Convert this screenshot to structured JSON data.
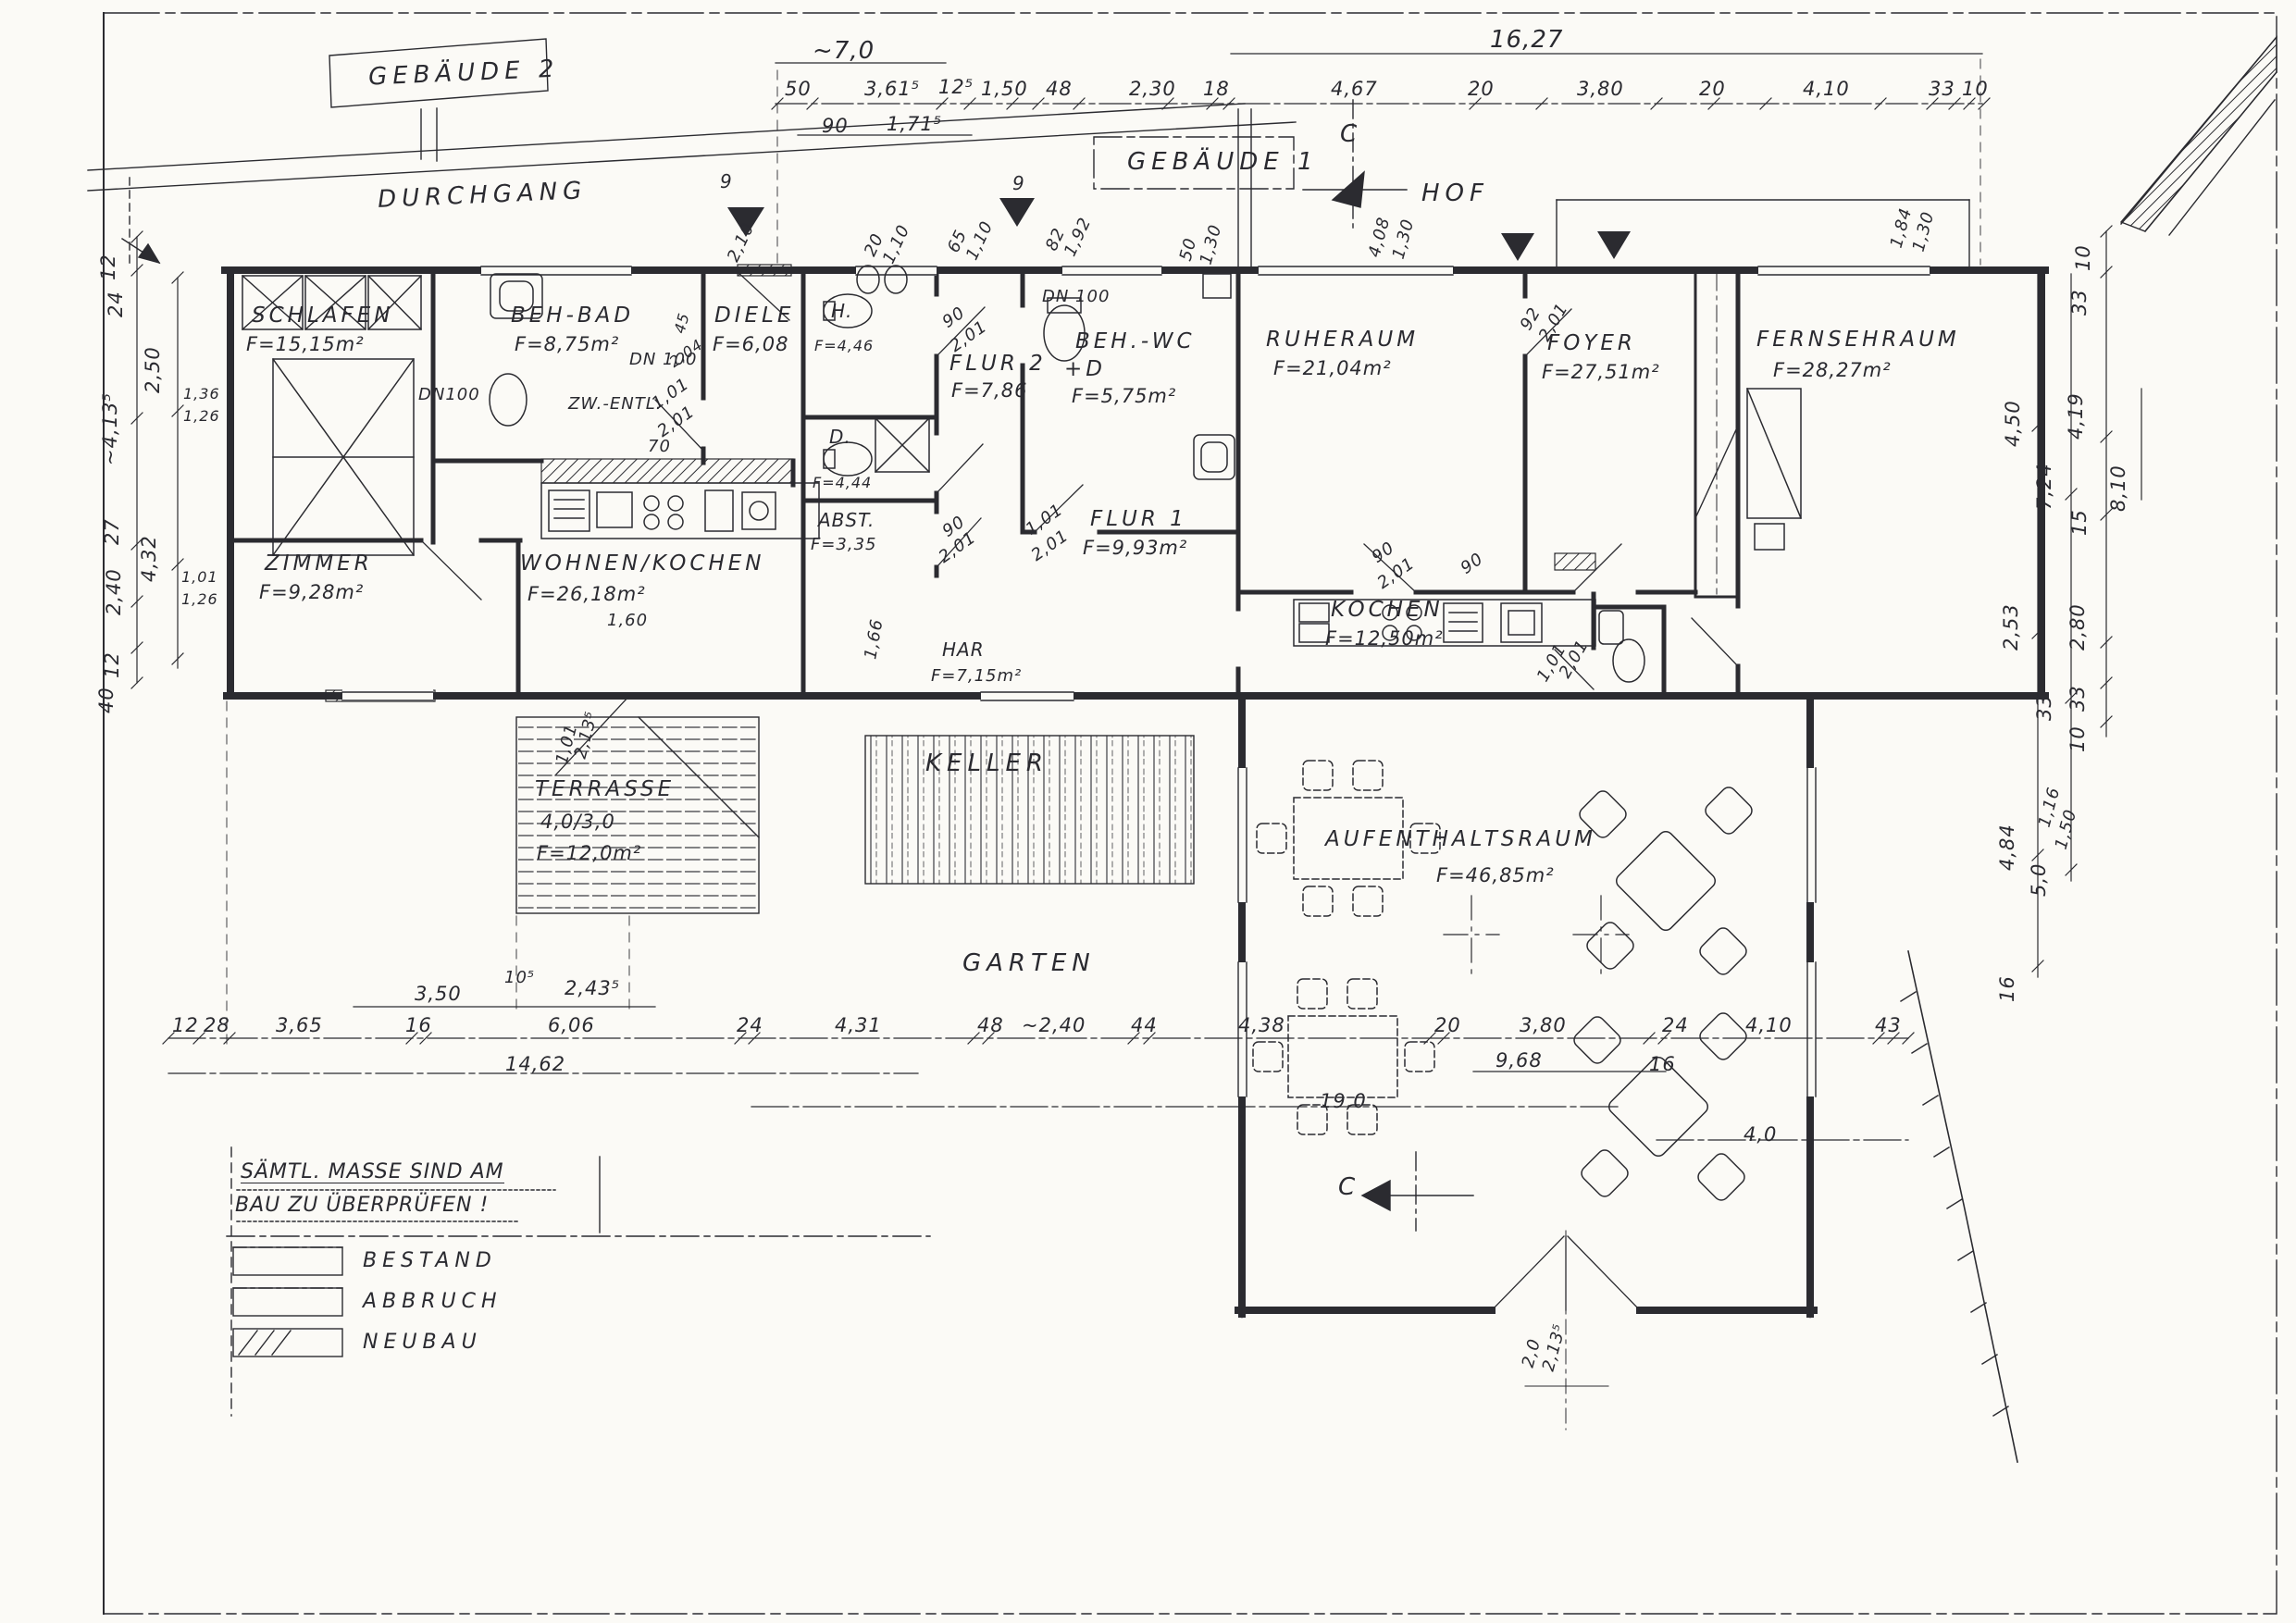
{
  "sheet": {
    "paper_color": "#fbfaf6",
    "ink_color": "#2b2b30"
  },
  "buildings": {
    "b2": "GEBÄUDE 2",
    "b1": "GEBÄUDE 1"
  },
  "zones": {
    "durchgang": "DURCHGANG",
    "hof": "HOF",
    "garten": "GARTEN",
    "keller": "KELLER",
    "terrasse": {
      "name": "TERRASSE",
      "dims": "4,0/3,0",
      "area": "F=12,0m²"
    }
  },
  "rooms": {
    "schlafen": {
      "name": "SCHLAFEN",
      "area": "F=15,15m²"
    },
    "behbad": {
      "name": "BEH-BAD",
      "area": "F=8,75m²"
    },
    "diele": {
      "name": "DIELE",
      "area": "F=6,08"
    },
    "h": {
      "name": "H.",
      "area": "F=4,46"
    },
    "d": {
      "name": "D.",
      "area": "F=4,44"
    },
    "flur2": {
      "name": "FLUR 2",
      "area": "F=7,86"
    },
    "behwc": {
      "name": "BEH.-WC",
      "name2": "+D",
      "area": "F=5,75m²"
    },
    "ruheraum": {
      "name": "RUHERAUM",
      "area": "F=21,04m²"
    },
    "foyer": {
      "name": "FOYER",
      "area": "F=27,51m²"
    },
    "fernsehraum": {
      "name": "FERNSEHRAUM",
      "area": "F=28,27m²"
    },
    "zimmer": {
      "name": "ZIMMER",
      "area": "F=9,28m²"
    },
    "wohnen": {
      "name": "WOHNEN/KOCHEN",
      "area": "F=26,18m²"
    },
    "abst": {
      "name": "ABST.",
      "area": "F=3,35"
    },
    "flur1": {
      "name": "FLUR 1",
      "area": "F=9,93m²"
    },
    "kochen": {
      "name": "KOCHEN",
      "area": "F=12,50m²"
    },
    "har": {
      "name": "HAR",
      "area": "F=7,15m²"
    },
    "aufenthaltsraum": {
      "name": "AUFENTHALTSRAUM",
      "area": "F=46,85m²"
    }
  },
  "note": {
    "line1": "SÄMTL. MASSE SIND AM",
    "line2": "BAU ZU ÜBERPRÜFEN !"
  },
  "legend": {
    "bestand": "BESTAND",
    "abbruch": "ABBRUCH",
    "neubau": "NEUBAU"
  },
  "section": {
    "label": "C"
  },
  "dims": {
    "top_overall_left": "~7,0",
    "top_overall_right": "16,27",
    "top_chain": [
      "50",
      "3,61⁵",
      "12⁵",
      "1,50",
      "48",
      "2,30",
      "18",
      "4,67",
      "20",
      "3,80",
      "20",
      "4,10",
      "33",
      "10"
    ],
    "top_sub": [
      "90",
      "1,71⁵"
    ],
    "bottom_upper": [
      "3,50",
      "10⁵",
      "2,43⁵"
    ],
    "bottom_chain": [
      "12",
      "28",
      "3,65",
      "16",
      "6,06",
      "24",
      "4,31",
      "48",
      "~2,40",
      "44",
      "4,38",
      "20",
      "3,80",
      "24",
      "4,10",
      "43"
    ],
    "bottom_sub": [
      "14,62",
      "9,68",
      "16"
    ],
    "bottom_lower": [
      "19,0",
      "4,0"
    ],
    "left_chain": [
      "12",
      "24",
      "2,50",
      "~4,13⁵",
      "1,36",
      "1,26",
      "27",
      "4,32",
      "2,40",
      "1,01",
      "1,26",
      "12",
      "40"
    ],
    "right_chain": [
      "10",
      "33",
      "4,19",
      "4,50",
      "7,24",
      "8,10",
      "15",
      "2,53",
      "2,80",
      "33",
      "33",
      "10",
      "4,84",
      "5,0",
      "16"
    ]
  },
  "ann": {
    "tri1": "9",
    "tri2": "9",
    "w1a": "2,10",
    "w2a": "20",
    "w2b": "1,10",
    "w3a": "65",
    "w3b": "1,10",
    "w4a": "82",
    "w4b": "1,92",
    "w5a": "50",
    "w5b": "1,30",
    "w6a": "4,08",
    "w6b": "1,30",
    "w7a": "1,84",
    "w7b": "1,30",
    "fd1a": "92",
    "fd1b": "2,01",
    "dn1": "DN 100",
    "dn2": "DN 100",
    "dn3": "DN100",
    "zw": "ZW.-ENTL.",
    "dd_a": "1,01",
    "dd_b": "2,01",
    "n45": "45",
    "n204": "2,04",
    "n70": "70",
    "hd_a": "90",
    "hd_b": "2,01",
    "ab_a": "90",
    "ab_b": "2,01",
    "f1_a": "1,01",
    "f1_b": "2,01",
    "rd_a": "90",
    "rd_b": "2,01",
    "n160": "1,60",
    "n166": "1,66",
    "k90": "90",
    "kd_a": "1,01",
    "kd_b": "2,01",
    "td_a": "1,01",
    "td_b": "2,13⁵",
    "ad_a": "2,0",
    "ad_b": "2,13⁵",
    "fr_a": "1,16",
    "fr_b": "1,50"
  }
}
